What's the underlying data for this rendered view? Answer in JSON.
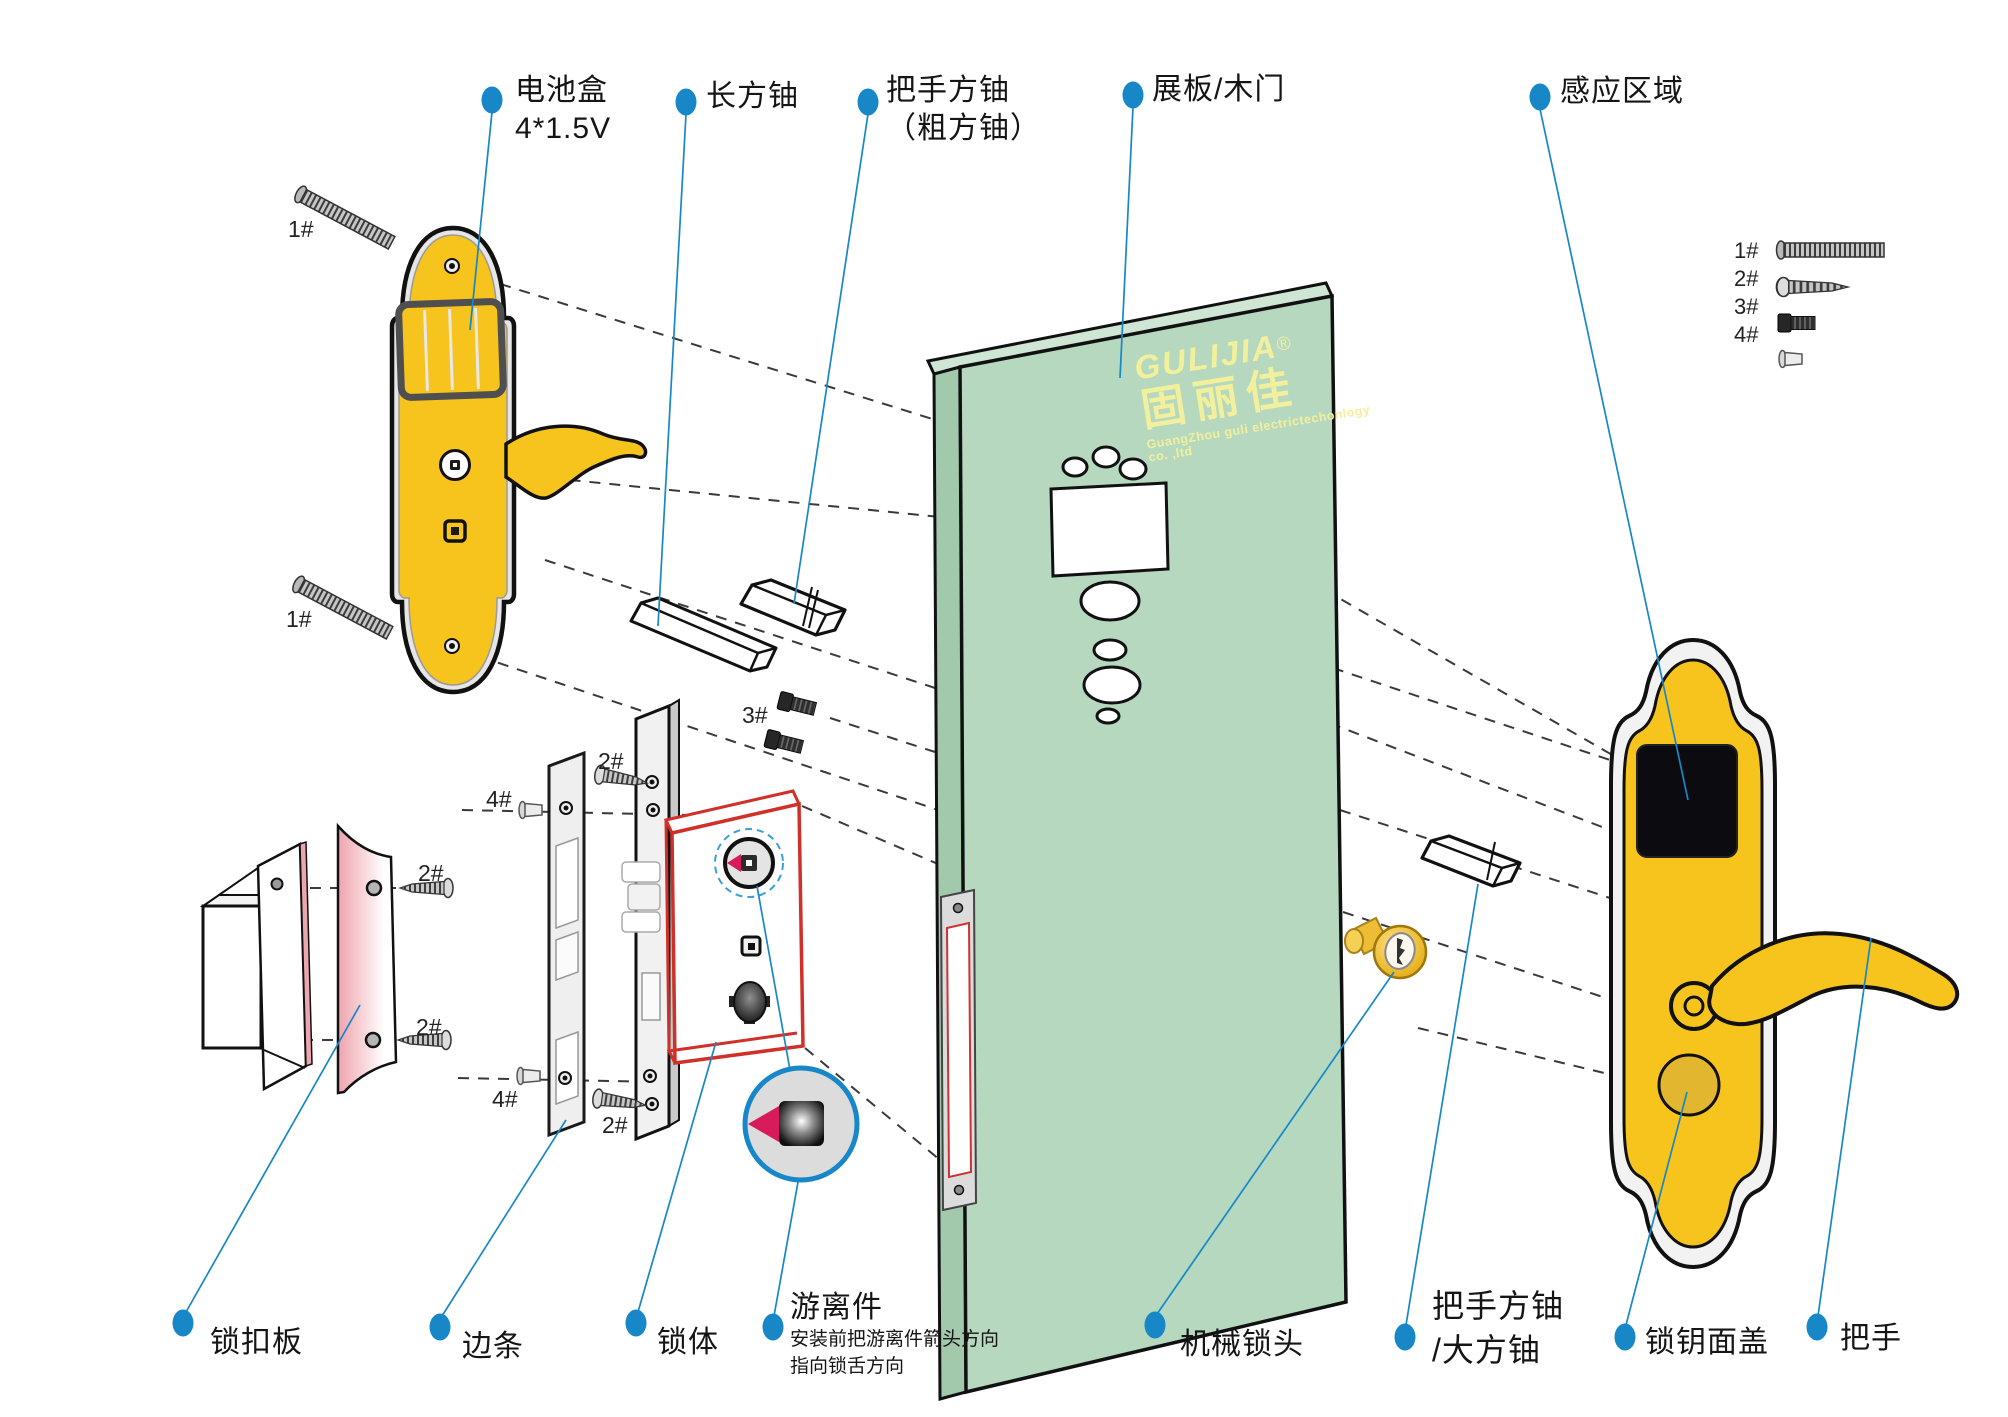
{
  "labels": {
    "battery": {
      "line1": "电池盒",
      "line2": "4*1.5V"
    },
    "long_shaft": {
      "line1": "长方铀"
    },
    "handle_shaft": {
      "line1": "把手方铀",
      "line2": "（粗方铀）"
    },
    "door": {
      "line1": "展板/木门"
    },
    "sensing": {
      "line1": "感应区域"
    },
    "strike_plate": {
      "line1": "锁扣板"
    },
    "edge_strip": {
      "line1": "边条"
    },
    "lock_body": {
      "line1": "锁体"
    },
    "floating": {
      "title": "游离件",
      "note1": "安装前把游离件箭头方向",
      "note2": "指向锁舌方向"
    },
    "cylinder": {
      "line1": "机械锁头"
    },
    "big_shaft": {
      "line1": "把手方铀",
      "line2": "/大方铀"
    },
    "key_cover": {
      "line1": "锁钥面盖"
    },
    "handle": {
      "line1": "把手"
    }
  },
  "screw_marks": {
    "legend1": "1#",
    "legend2": "2#",
    "legend3": "3#",
    "legend4": "4#",
    "tag_1a": "1#",
    "tag_1b": "1#",
    "tag_2a": "2#",
    "tag_2b": "2#",
    "tag_2c": "2#",
    "tag_2d": "2#",
    "tag_3": "3#",
    "tag_4a": "4#",
    "tag_4b": "4#"
  },
  "logo": {
    "brand": "GULIJIA",
    "registered": "®",
    "brand_cn": "固丽佳",
    "company": "GuangZhou guli electrictechonlogy co. ,ltd"
  },
  "colors": {
    "leader_blue": "#1787c8",
    "plate_yellow": "#f6c41d",
    "door_green": "#b5d8bf",
    "lock_body_red": "#d03028",
    "arrow_crimson": "#d81b5a"
  }
}
